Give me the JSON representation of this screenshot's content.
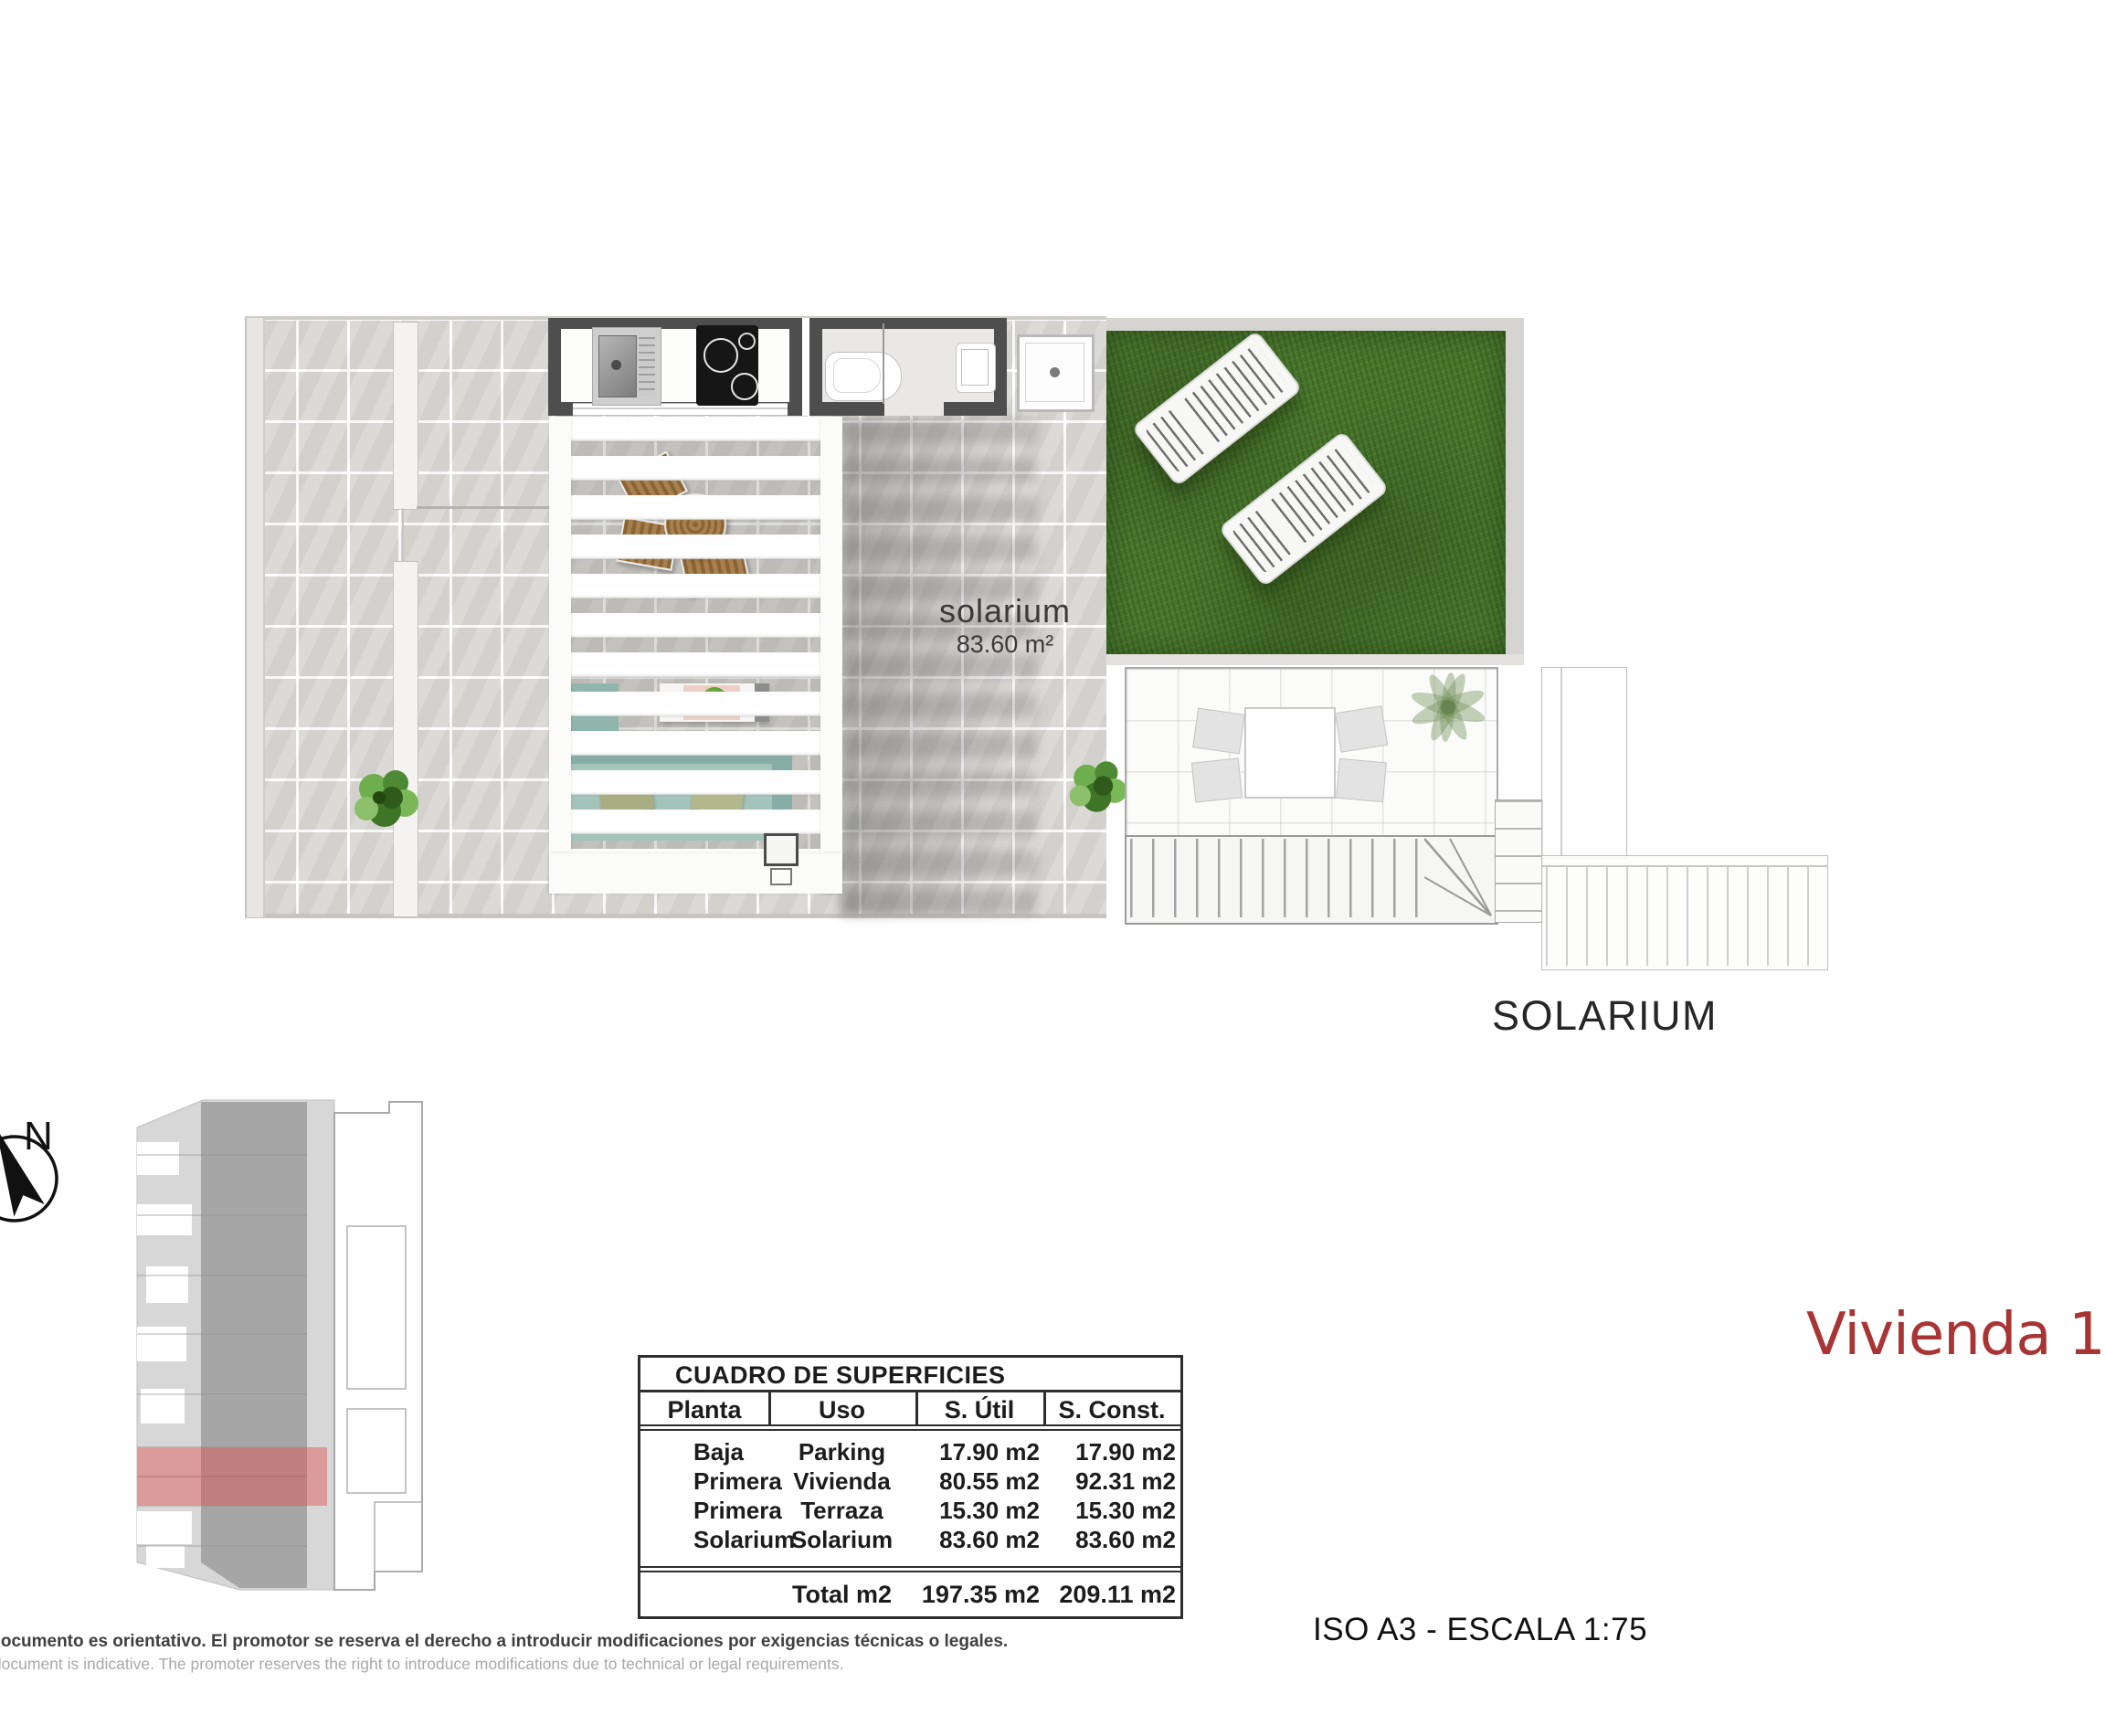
{
  "floorplan": {
    "room_label": "solarium",
    "room_area": "83.60 m²",
    "caption": "SOLARIUM"
  },
  "surfaces_table": {
    "title": "CUADRO DE SUPERFICIES",
    "headers": [
      "Planta",
      "Uso",
      "S. Útil",
      "S. Const."
    ],
    "rows": [
      {
        "planta": "Baja",
        "uso": "Parking",
        "util": "17.90 m2",
        "const": "17.90 m2"
      },
      {
        "planta": "Primera",
        "uso": "Vivienda",
        "util": "80.55 m2",
        "const": "92.31 m2"
      },
      {
        "planta": "Primera",
        "uso": "Terraza",
        "util": "15.30 m2",
        "const": "15.30 m2"
      },
      {
        "planta": "Solarium",
        "uso": "Solarium",
        "util": "83.60 m2",
        "const": "83.60 m2"
      }
    ],
    "total": {
      "label": "Total m2",
      "util": "197.35 m2",
      "const": "209.11 m2"
    }
  },
  "titles": {
    "unit_name": "Vivienda 1",
    "scale_note": "ISO A3 - ESCALA 1:75"
  },
  "keyplan": {
    "north_label": "N",
    "highlight_color": "#c07e7e"
  },
  "disclaimer": {
    "spanish": "El documento es orientativo. El promotor se reserva el derecho a introducir modificaciones por exigencias técnicas o legales.",
    "english": "This document is indicative. The promoter reserves the right to introduce modifications due to technical or legal requirements."
  },
  "colors": {
    "accent_red": "#a93434",
    "grass_green": "#48762b",
    "wall_dark": "#4e4e4e",
    "tile_gray": "#d8d6d3",
    "sofa_teal": "#93b7b0",
    "wood_brown": "#9c7544",
    "ghost_gray": "#a9a9a9"
  }
}
